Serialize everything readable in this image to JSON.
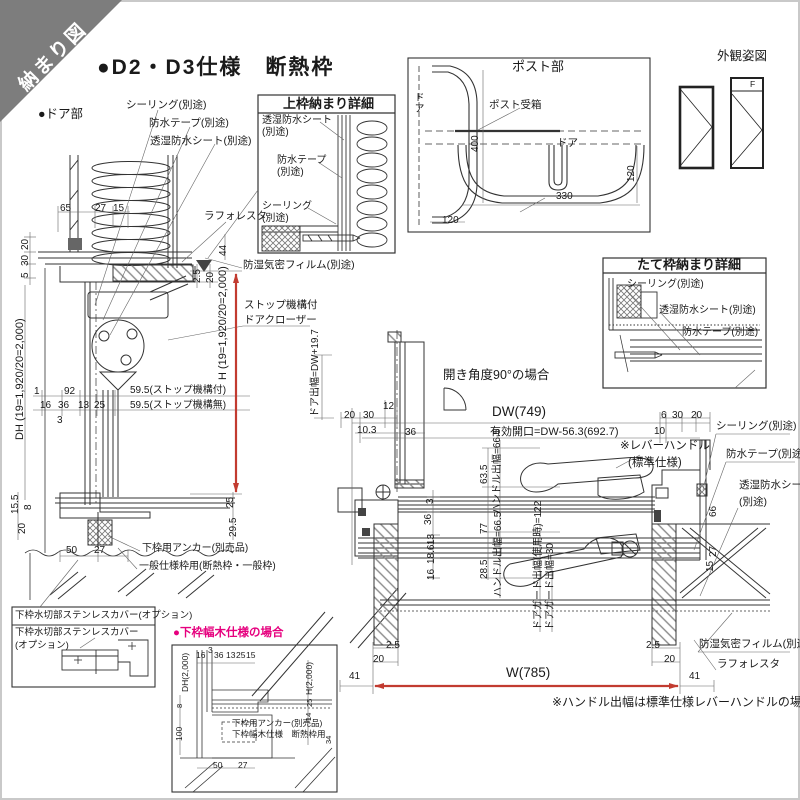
{
  "banner": {
    "label": "納まり図"
  },
  "header": {
    "title": "●D2・D3仕様　断熱枠",
    "door_part": "●ドア部"
  },
  "colors": {
    "accent_red": "#c23b30",
    "accent_magenta": "#e6007e",
    "banner_gray": "#7d7d7d"
  },
  "left": {
    "sealing": "シーリング(別途)",
    "tape": "防水テープ(別途)",
    "sheet": "透湿防水シート(別途)",
    "laforesta": "ラフォレスタ",
    "film": "防湿気密フィルム(別途)",
    "closer1": "ストップ機構付",
    "closer2": "ドアクローザー",
    "stop1": "59.5(ストップ機構付)",
    "stop2": "59.5(ストップ機構無)",
    "anchor": "下枠用アンカー(別売品)",
    "general": "一般仕様枠用(断熱枠・一般枠)",
    "d65": "65",
    "d27": "27",
    "d15": "15",
    "d20a": "20",
    "d30": "30",
    "d5": "5",
    "dh": "DH (19=1,920/20=2,000)",
    "h": "H (19=1,920/20=2,000)",
    "d1": "1",
    "d92": "92",
    "d16": "16",
    "d36": "36",
    "d13": "13",
    "d25": "25",
    "d3": "3",
    "d155": "15.5",
    "d8": "8",
    "d20b": "20",
    "d50": "50",
    "d27b": "27",
    "d44": "44",
    "d25r": "2.5",
    "d20r": "20",
    "d25c": "25",
    "d295": "29.5"
  },
  "kamiwaku": {
    "title": "上枠納まり詳細",
    "sheet1": "透湿防水シート",
    "sheet2": "(別途)",
    "tape1": "防水テープ",
    "tape2": "(別途)",
    "seal1": "シーリング",
    "seal2": "(別途)"
  },
  "post": {
    "title": "ポスト部",
    "door_v": "ドア",
    "door_c": "ドア",
    "receiver_top": "ポスト受箱",
    "receiver_bottom": "ポスト受箱",
    "d400": "400",
    "d120r": "120",
    "d330": "330",
    "d120b": "120"
  },
  "gaikan": {
    "title": "外観姿図",
    "f": "F"
  },
  "tatewaku": {
    "title": "たて枠納まり詳細",
    "seal": "シーリング(別途)",
    "sheet": "透湿防水シート(別途)",
    "tape": "防水テープ(別途)"
  },
  "plan": {
    "open_angle": "開き角度90°の場合",
    "door_width": "ドア出幅=DW+19.7",
    "dw": "DW(749)",
    "kaikou": "有効開口=DW-56.3(692.7)",
    "d20": "20",
    "d30": "30",
    "d12": "12",
    "d103": "10.3",
    "d36": "36",
    "d6": "6",
    "d30b": "30",
    "d20b": "20",
    "d10": "10",
    "lever1": "※レバーハンドル",
    "lever2": "(標準仕様)",
    "seal": "シーリング(別途)",
    "tape": "防水テープ(別途)",
    "sheet1": "透湿防水シート",
    "sheet2": "(別途)",
    "d66": "66",
    "d27": "27",
    "d15": "15",
    "d635": "63.5",
    "handle1": "ハンドル出幅=66.5",
    "d3": "3",
    "d36v": "36",
    "d77": "77",
    "d16": "16",
    "d186": "18.6",
    "d13": "13",
    "d285": "28.5",
    "handle2": "ハンドル出幅=66.5",
    "guard1": "ドアガード出幅(使用時)=122",
    "guard2": "ドアガード出幅=30",
    "film": "防湿気密フィルム(別途)",
    "laforesta": "ラフォレスタ",
    "d25L": "2.5",
    "d20L": "20",
    "d41L": "41",
    "w": "W(785)",
    "d25R": "2.5",
    "d20R": "20",
    "d41R": "41",
    "note": "※ハンドル出幅は標準仕様レバーハンドルの場合"
  },
  "sinkbox": {
    "header": "下枠水切部ステンレスカバー(オプション)",
    "label1": "下枠水切部ステンレスカバー",
    "label2": "(オプション)"
  },
  "habaki": {
    "title": "●下枠幅木仕様の場合",
    "dh": "DH(2,000)",
    "h": "H(2,000)",
    "d16": "16",
    "d3": "3",
    "d36": "36",
    "d13": "13",
    "d25": "25",
    "d15": "15",
    "d8": "8",
    "d100": "100",
    "d50": "50",
    "d27": "27",
    "d25v": "25",
    "d14": "14",
    "d34": "34",
    "anchor": "下枠用アンカー(別売品)",
    "habaki_label": "下枠幅木仕様　断熱枠用"
  }
}
